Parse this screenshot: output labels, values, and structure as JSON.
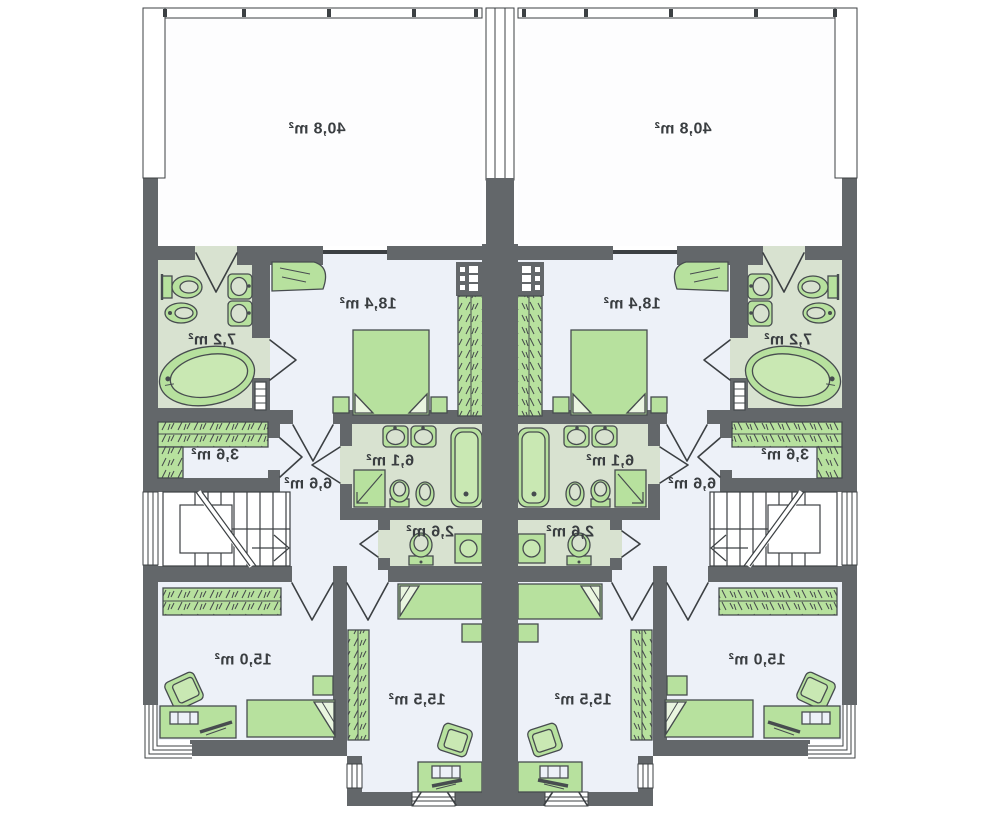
{
  "meta": {
    "type": "floor-plan",
    "description": "Semi-detached duplex upper floor plan, two mirrored units, room area labels rendered mirrored",
    "units_count": 2,
    "text_mirrored": true
  },
  "palette": {
    "wall": "#63676a",
    "outline": "#3c4043",
    "furniture": "#b7e19e",
    "furniture_light": "#e9f5df",
    "bath_floor": "#d8e2d0",
    "room_floor": "#edf1f8",
    "background": "#ffffff"
  },
  "plan": {
    "units": [
      {
        "id": "left",
        "rooms": [
          {
            "name": "terrace",
            "area": "40,8 m²",
            "x": 317,
            "y": 129
          },
          {
            "name": "bedroom",
            "area": "18,4 m²",
            "x": 368,
            "y": 304
          },
          {
            "name": "bathroom",
            "area": "7,2 m²",
            "x": 212,
            "y": 340
          },
          {
            "name": "wardrobe",
            "area": "3,6 m²",
            "x": 215,
            "y": 455
          },
          {
            "name": "hall",
            "area": "6,6 m²",
            "x": 308,
            "y": 484
          },
          {
            "name": "bathroom-small",
            "area": "6,1 m²",
            "x": 390,
            "y": 461
          },
          {
            "name": "wc",
            "area": "2,6 m²",
            "x": 430,
            "y": 532
          },
          {
            "name": "room-15-0",
            "area": "15,0 m²",
            "x": 243,
            "y": 660
          },
          {
            "name": "room-15-5",
            "area": "15,5 m²",
            "x": 417,
            "y": 700
          }
        ]
      },
      {
        "id": "right",
        "rooms": [
          {
            "name": "terrace",
            "area": "40,8 m²",
            "x": 683,
            "y": 129
          },
          {
            "name": "bedroom",
            "area": "18,4 m²",
            "x": 632,
            "y": 304
          },
          {
            "name": "bathroom",
            "area": "7,2 m²",
            "x": 788,
            "y": 340
          },
          {
            "name": "wardrobe",
            "area": "3,6 m²",
            "x": 785,
            "y": 455
          },
          {
            "name": "hall",
            "area": "6,6 m²",
            "x": 692,
            "y": 484
          },
          {
            "name": "bathroom-small",
            "area": "6,1 m²",
            "x": 610,
            "y": 461
          },
          {
            "name": "wc",
            "area": "2,6 m²",
            "x": 570,
            "y": 532
          },
          {
            "name": "room-15-0",
            "area": "15,0 m²",
            "x": 757,
            "y": 660
          },
          {
            "name": "room-15-5",
            "area": "15,5 m²",
            "x": 583,
            "y": 700
          }
        ]
      }
    ]
  }
}
